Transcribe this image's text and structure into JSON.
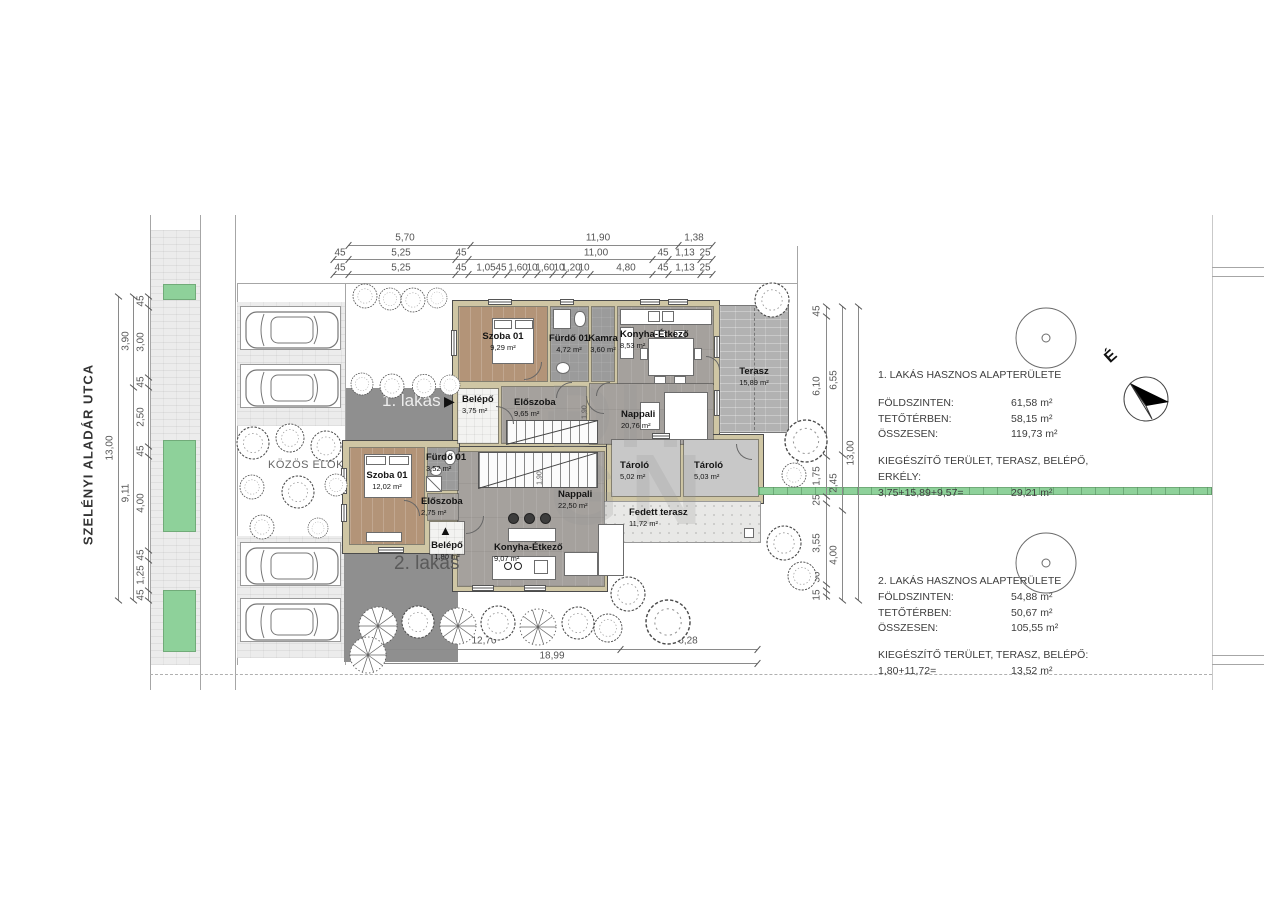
{
  "street": {
    "name": "SZELÉNYI ALADÁR UTCA"
  },
  "site": {
    "front_garden_label": "KÖZÖS ELŐKERT",
    "north_label": "É",
    "watermark": [
      "ĐH",
      "G",
      "N"
    ]
  },
  "apartments": {
    "a1": {
      "tag": "1. lakás",
      "arrow": "▶",
      "rooms": {
        "szoba": {
          "name": "Szoba 01",
          "area": "9,29 m²"
        },
        "furdo": {
          "name": "Fürdő 01",
          "area": "4,72 m²"
        },
        "kamra": {
          "name": "Kamra",
          "area": "3,60 m²"
        },
        "konyha": {
          "name": "Konyha-Étkező",
          "area": "8,53 m²"
        },
        "belepo": {
          "name": "Belépő",
          "area": "3,75 m²"
        },
        "eloszoba": {
          "name": "Előszoba",
          "area": "9,65 m²"
        },
        "nappali": {
          "name": "Nappali",
          "area": "20,76 m²"
        },
        "terasz": {
          "name": "Terasz",
          "area": "15,89 m²"
        }
      }
    },
    "a2": {
      "tag": "2. lakás",
      "arrow": "▲",
      "rooms": {
        "szoba": {
          "name": "Szoba 01",
          "area": "12,02 m²"
        },
        "furdo": {
          "name": "Fürdő 01",
          "area": "3,52 m²"
        },
        "eloszoba": {
          "name": "Előszoba",
          "area": "2,75 m²"
        },
        "belepo": {
          "name": "Belépő",
          "area": "1,80 m²"
        },
        "nappali": {
          "name": "Nappali",
          "area": "22,50 m²"
        },
        "konyha": {
          "name": "Konyha-Étkező",
          "area": "9,07 m²"
        },
        "fedett": {
          "name": "Fedett terasz",
          "area": "11,72 m²"
        }
      }
    }
  },
  "storage": {
    "t1": {
      "name": "Tároló",
      "area": "5,02 m²"
    },
    "t2": {
      "name": "Tároló",
      "area": "5,03 m²"
    }
  },
  "summary1": {
    "title": "1. LAKÁS HASZNOS ALAPTERÜLETE",
    "rows": [
      [
        "FÖLDSZINTEN:",
        "61,58 m²"
      ],
      [
        "TETŐTÉRBEN:",
        "58,15 m²"
      ],
      [
        "ÖSSZESEN:",
        "119,73 m²"
      ]
    ],
    "extra_title": "KIEGÉSZÍTŐ TERÜLET, TERASZ, BELÉPŐ, ERKÉLY:",
    "extra_calc": "3,75+15,89+9,57=",
    "extra_value": "29,21 m²"
  },
  "summary2": {
    "title": "2. LAKÁS HASZNOS ALAPTERÜLETE",
    "rows": [
      [
        "FÖLDSZINTEN:",
        "54,88 m²"
      ],
      [
        "TETŐTÉRBEN:",
        "50,67 m²"
      ],
      [
        "ÖSSZESEN:",
        "105,55 m²"
      ]
    ],
    "extra_title": "KIEGÉSZÍTŐ TERÜLET, TERASZ, BELÉPŐ:",
    "extra_calc": "1,80+11,72=",
    "extra_value": "13,52 m²"
  },
  "dims": {
    "top_row1": [
      "5,70",
      "11,90",
      "1,38"
    ],
    "top_row2": [
      "45",
      "5,25",
      "45",
      "11,00",
      "45",
      "1,13",
      "25"
    ],
    "top_row3": [
      "45",
      "5,25",
      "45",
      "1,05",
      "45",
      "1,60",
      "10",
      "1,60",
      "10",
      "1,20",
      "10",
      "4,80",
      "45",
      "1,13",
      "25"
    ],
    "left_outer": [
      "13,00"
    ],
    "left_mid": [
      "3,90",
      "9,11"
    ],
    "left_inner": [
      "45",
      "3,00",
      "45",
      "2,50",
      "45",
      "4,00",
      "45",
      "1,25",
      "45"
    ],
    "right_outer": [
      "13,00"
    ],
    "right_mid": [
      "6,55",
      "2,45",
      "4,00"
    ],
    "right_inner": [
      "45",
      "6,10",
      "1,75",
      "25",
      "3,55",
      "30",
      "15"
    ],
    "bottom_row1": [
      "12,70",
      "6,28"
    ],
    "bottom_row2": [
      "18,99"
    ],
    "stair_dim": "1,90"
  },
  "colors": {
    "wall": "#cfc6a4",
    "wood_gray": "#a5a19d",
    "wood_brown": "#b39478",
    "green": "#8ed19a",
    "driveway": "#8f8f8f"
  }
}
